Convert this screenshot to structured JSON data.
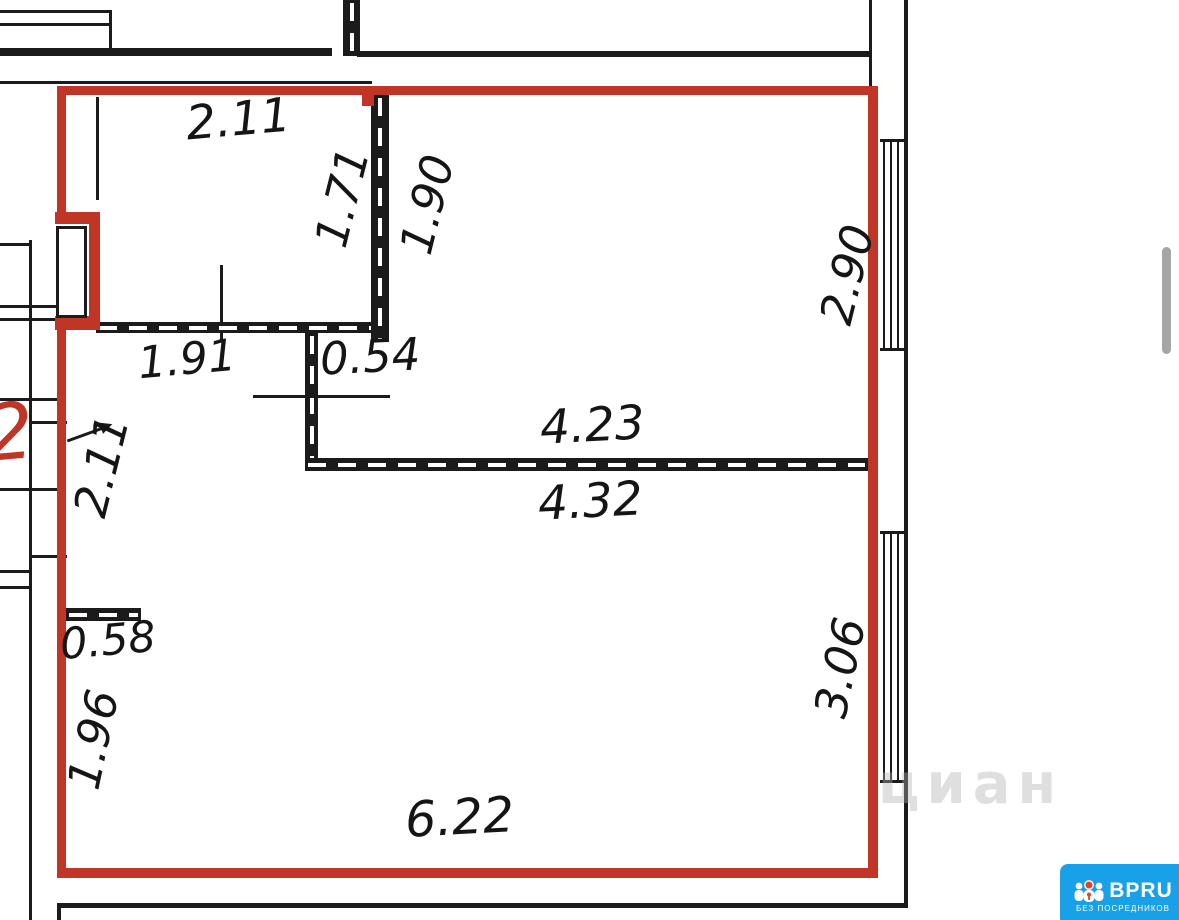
{
  "plan": {
    "apartment_label": "2",
    "labels": {
      "top_room_width": "2.11",
      "top_room_height": "1.71",
      "niche_depth": "1.90",
      "upper_right_room_height": "2.90",
      "top_room_bottom_width": "1.91",
      "partition_stub": "0.54",
      "middle_wall_upper": "4.23",
      "middle_wall_lower": "4.32",
      "left_wall_middle": "2.11",
      "lower_stub": "0.58",
      "left_wall_lower": "1.96",
      "lower_right_room_height": "3.06",
      "bottom_width": "6.22"
    },
    "colors": {
      "boundary_red": "#c13527",
      "wall_black": "#1b1b1b"
    }
  },
  "watermark": {
    "text": "циан"
  },
  "logo": {
    "brand": "BPRU",
    "tagline": "БЕЗ ПОСРЕДНИКОВ",
    "background": "#18a0e8",
    "icon": "people-icon"
  },
  "scrollbar": {
    "color": "#a6a6a6"
  }
}
